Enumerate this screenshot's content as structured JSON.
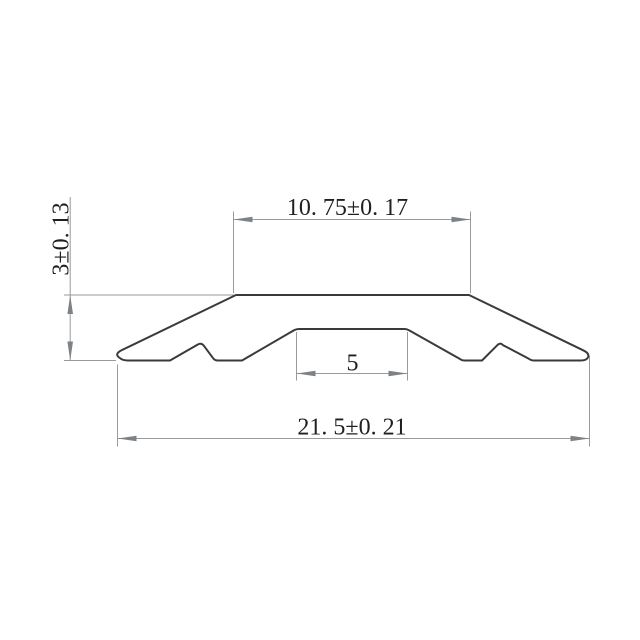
{
  "drawing": {
    "kind": "technical-drawing-cross-section",
    "description": "Cross-section profile of a flat threshold/transition strip with center groove, annotated with toleranced dimensions",
    "background_color": "#ffffff",
    "outline_color": "#3a3a3a",
    "dimension_line_color": "#9a9a9a",
    "arrowhead_color": "#7d8287",
    "text_color": "#1f1f1f"
  },
  "dims": {
    "top_width": {
      "label": "10. 75±0. 17",
      "value": 10.75,
      "tolerance": 0.17,
      "orientation": "horizontal"
    },
    "height": {
      "label": "3±0. 13",
      "value": 3,
      "tolerance": 0.13,
      "orientation": "vertical"
    },
    "groove_width": {
      "label": "5",
      "value": 5,
      "orientation": "horizontal"
    },
    "overall_width": {
      "label": "21. 5±0. 21",
      "value": 21.5,
      "tolerance": 0.21,
      "orientation": "horizontal"
    }
  }
}
